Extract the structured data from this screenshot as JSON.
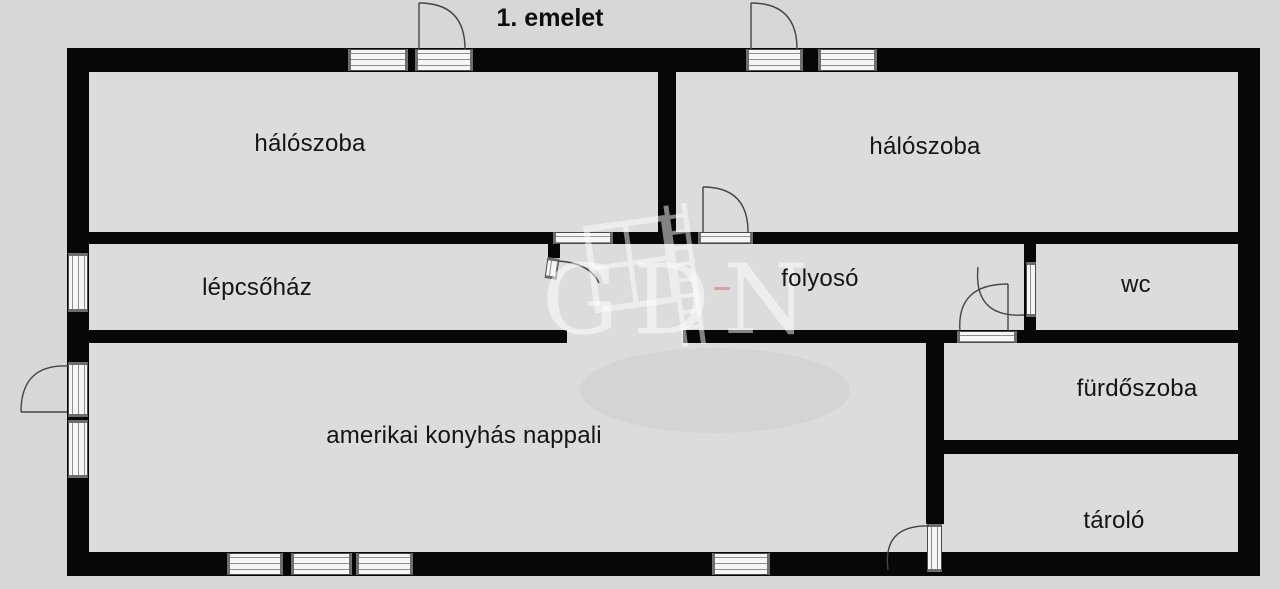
{
  "title": "1. emelet",
  "watermark": {
    "text": "GDN",
    "logo": "window-and-ladder-logo"
  },
  "rooms": {
    "bedroom_left": {
      "label": "hálószoba"
    },
    "bedroom_right": {
      "label": "hálószoba"
    },
    "staircase": {
      "label": "lépcsőház"
    },
    "corridor": {
      "label": "folyosó"
    },
    "wc": {
      "label": "wc"
    },
    "bathroom": {
      "label": "fürdőszoba"
    },
    "storage": {
      "label": "tároló"
    },
    "living_room": {
      "label": "amerikai konyhás nappali"
    }
  },
  "colors": {
    "background": "#d7d7d7",
    "room_fill": "#dcdcdc",
    "wall": "#070707",
    "symbol_fill": "#f6f6f6",
    "watermark": "rgba(255,255,255,0.5)"
  }
}
